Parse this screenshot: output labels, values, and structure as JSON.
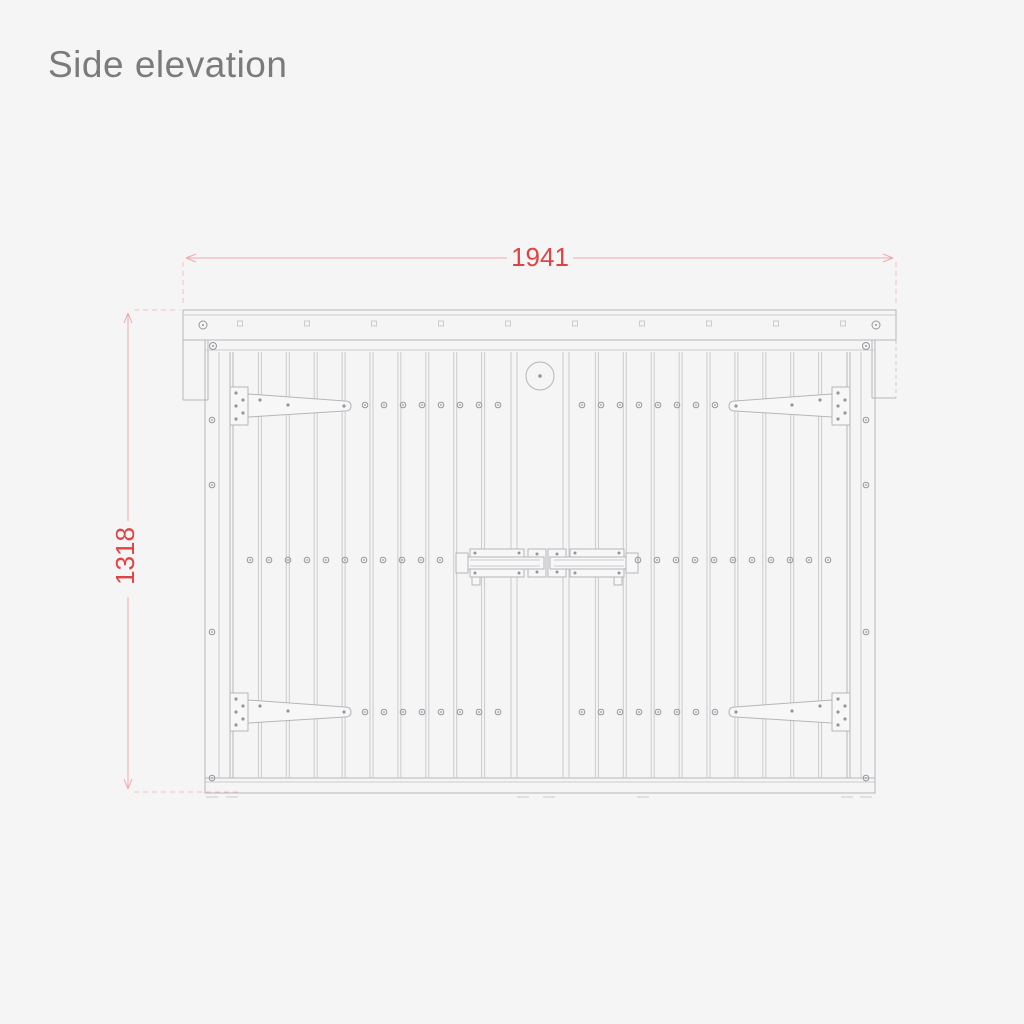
{
  "title": "Side elevation",
  "dimensions": {
    "width_label": "1941",
    "height_label": "1318"
  },
  "colors": {
    "background": "#f5f5f6",
    "title_text": "#7b7b7d",
    "drawing_line": "#b6b6ba",
    "drawing_line_light": "#cbcbcf",
    "screw": "#97979b",
    "dimension_line": "#eeaaab",
    "dimension_extension": "#f2bfc0",
    "dimension_text": "#e04343"
  }
}
